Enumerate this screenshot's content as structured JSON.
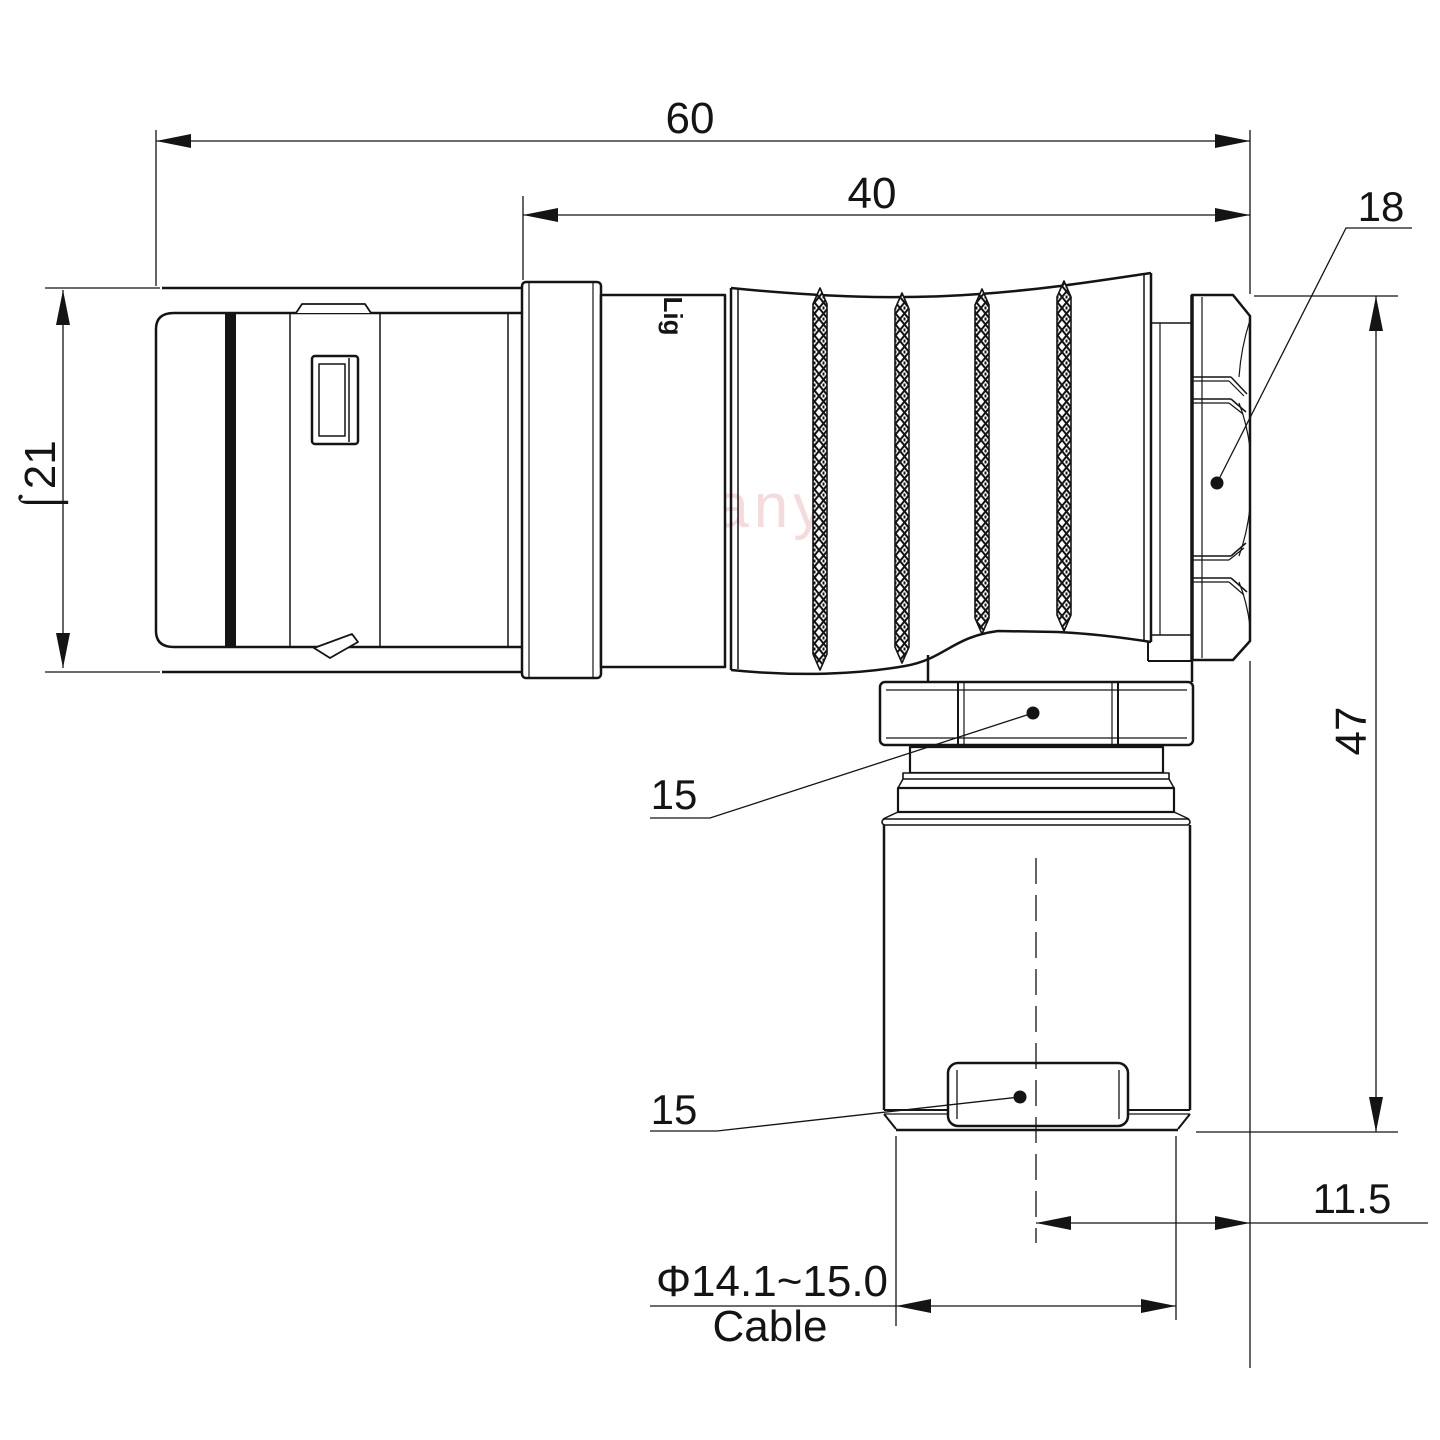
{
  "title": "Right-angle connector technical drawing",
  "watermark": "Lightany",
  "brand_stamp": "Lig",
  "dimensions": {
    "overall_length": "60",
    "body_length": "40",
    "backnut_size": "18",
    "shell_diameter": "⌠21",
    "overall_height": "47",
    "coupling_nut_upper": "15",
    "coupling_nut_lower": "15",
    "elbow_offset": "11.5",
    "cable_diameter_range": "Φ14.1~15.0",
    "cable_label": "Cable"
  },
  "colors": {
    "line": "#141414",
    "watermark": "#f0c4c4",
    "background": "#ffffff"
  }
}
